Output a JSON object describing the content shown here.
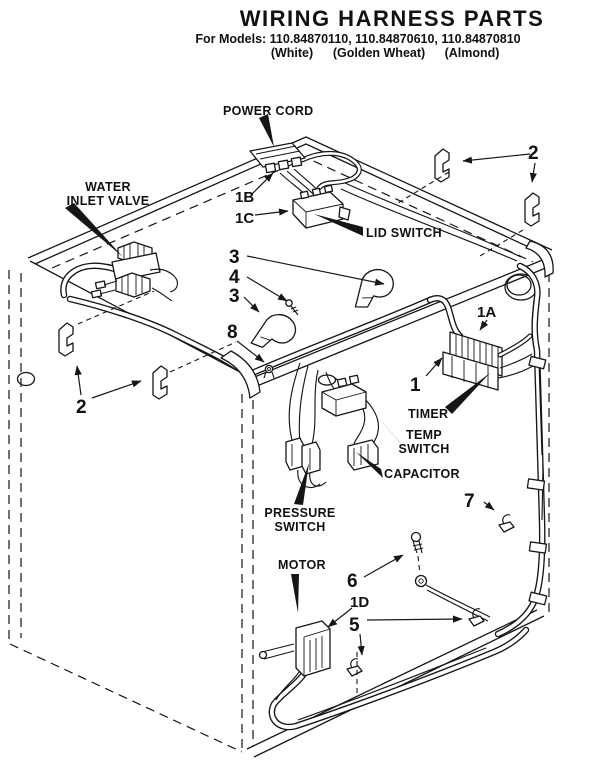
{
  "header": {
    "title": "WIRING HARNESS PARTS",
    "models_line": "For Models: 110.84870110, 110.84870610, 110.84870810",
    "colors": [
      "(White)",
      "(Golden Wheat)",
      "(Almond)"
    ]
  },
  "labels": {
    "power_cord": "POWER CORD",
    "water_inlet_l1": "WATER",
    "water_inlet_l2": "INLET VALVE",
    "lid_switch": "LID SWITCH",
    "timer": "TIMER",
    "temp_l1": "TEMP",
    "temp_l2": "SWITCH",
    "capacitor": "CAPACITOR",
    "pressure_l1": "PRESSURE",
    "pressure_l2": "SWITCH",
    "motor": "MOTOR"
  },
  "callouts": {
    "n1": "1",
    "n1a": "1A",
    "n1b": "1B",
    "n1c": "1C",
    "n1d": "1D",
    "n2": "2",
    "n3": "3",
    "n4": "4",
    "n5": "5",
    "n6": "6",
    "n7": "7",
    "n8": "8"
  }
}
